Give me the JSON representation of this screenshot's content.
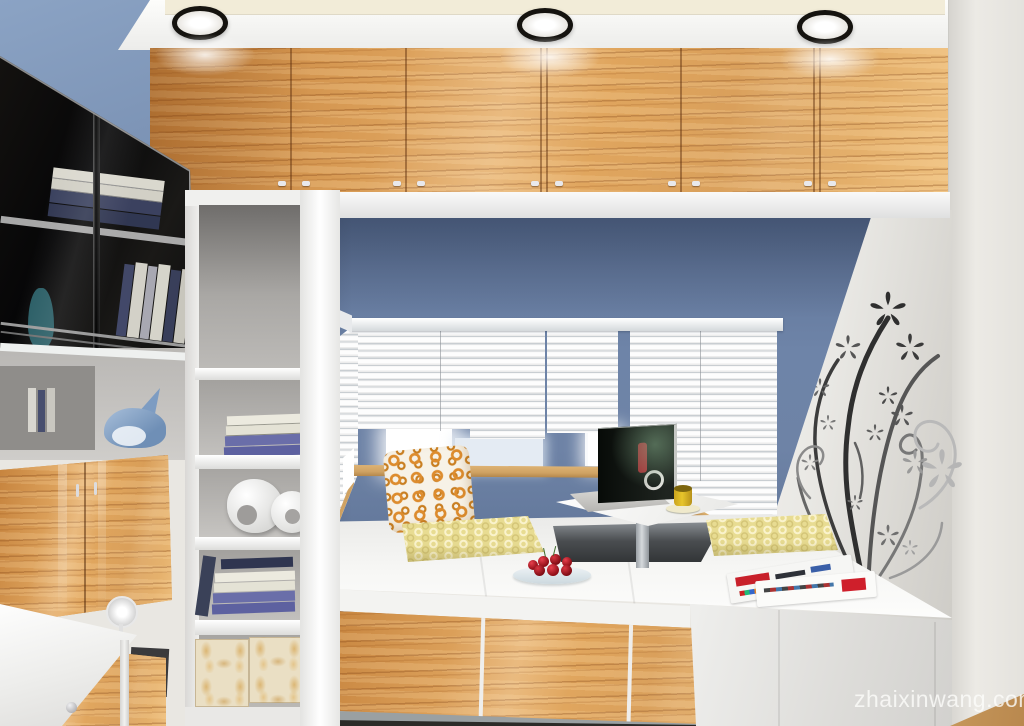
{
  "watermark": {
    "text": "zhaixinwang.com"
  },
  "scene": {
    "type": "3d-interior-rendering",
    "ceiling_lights": 3
  },
  "colors": {
    "wall_blue": "#6e83a6",
    "wall_blue_dark": "#566b8f",
    "wood_dark": "#c5823c",
    "wood_mid": "#d7994f",
    "wood_light": "#e6ae68",
    "wood_light2": "#eec07f",
    "ceiling": "#f3f2ee",
    "ceiling_panel": "#f2ecd8",
    "right_wall": "#e9e7e2",
    "platform": "#f5f5f2",
    "cushion": "#e8dc92",
    "cushion_ring": "#faf3cd",
    "pillow_ring": "#dd8c2e",
    "blind_light": "#fdfdfd",
    "blind_dark": "#c9ced2",
    "sill": "#cfa263",
    "glass_black": "#0d0d0f",
    "book_purple": "#6a6ea9",
    "book_cream": "#eceadf",
    "mug_yellow": "#e7c52b",
    "cherry_red": "#b51423",
    "decal_gray": "#4a4a4a",
    "floor_dark": "#2c2b28",
    "floor_wood": "#c89a5d"
  }
}
